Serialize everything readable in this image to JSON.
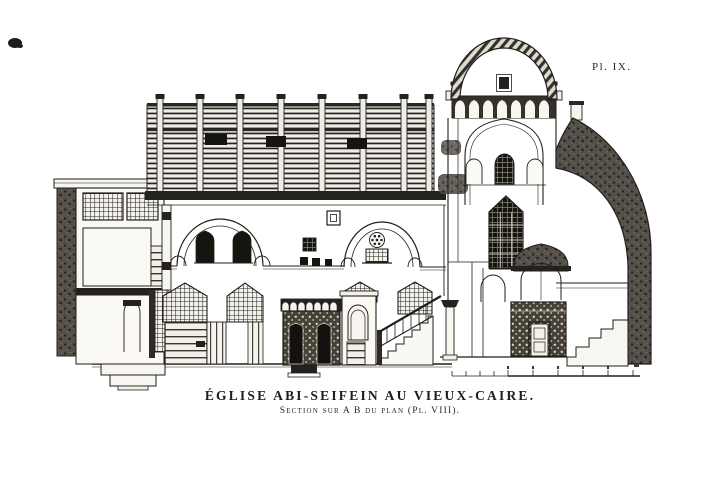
{
  "meta": {
    "paper": "#ffffff",
    "ink": "#221f1b"
  },
  "plate": {
    "label": "Pl. IX."
  },
  "caption": {
    "title": "ÉGLISE ABI-SEIFEIN AU VIEUX-CAIRE.",
    "subtitle": "Section sur A B du plan (Pl. VIII)."
  },
  "drawing": {
    "alt": "Engraved longitudinal section of the church of Abi-Seifein in Old Cairo: lattice-screened stair tower at left, timber-roofed nave with arcade arches and mashrabiya screens, ambon with stair, domed sanctuary tower, dark sanctuary screen, hatched apse wall with synthronon steps, and a graphic scale bar below",
    "parts": [
      "stair-tower",
      "timber-roof",
      "nave-arches",
      "nave-screens",
      "choir-screen",
      "ambon",
      "sanctuary-stair",
      "sanctuary-tower",
      "dome",
      "sanctuary-screen",
      "apse-wall",
      "scale-bar"
    ]
  }
}
